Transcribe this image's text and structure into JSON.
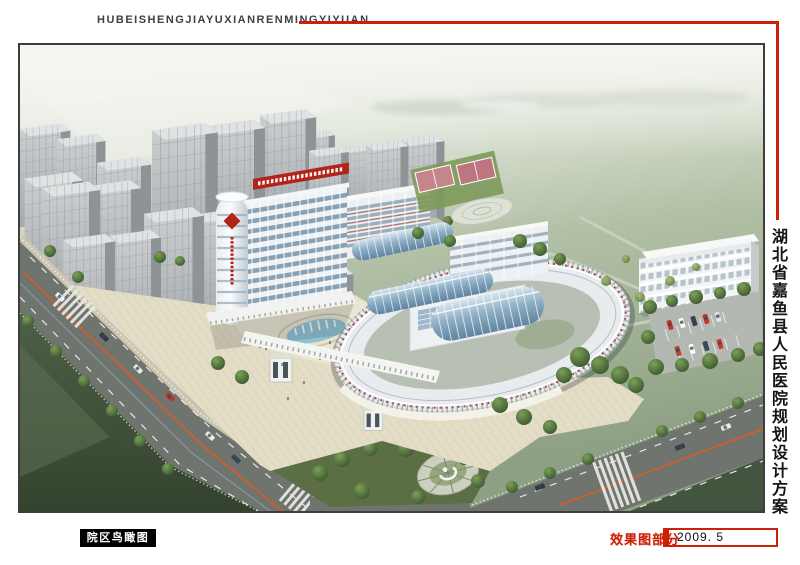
{
  "header": {
    "title": "HUBEISHENGJIAYUXIANRENMINGYIYUAN"
  },
  "side_title": {
    "text": "湖北省嘉鱼县人民医院规划设计方案"
  },
  "footer": {
    "view_label": "院区鸟瞰图",
    "section_label": "效果图部分",
    "date": "2009. 5"
  },
  "theme": {
    "accent_red": "#cc2008",
    "title_text": "#3f3f3f",
    "page_bg": "#ffffff",
    "frame_border": "#3e3e3e",
    "label_bg": "#000000",
    "label_text": "#ffffff",
    "date_text": "#111111",
    "hospital_sign_red": "#b2231a",
    "road_gray": "#70746f",
    "lawn_green": "#4a5b44",
    "plaza_beige": "#e3ddc6",
    "glass_blue": "#9db8cc"
  }
}
